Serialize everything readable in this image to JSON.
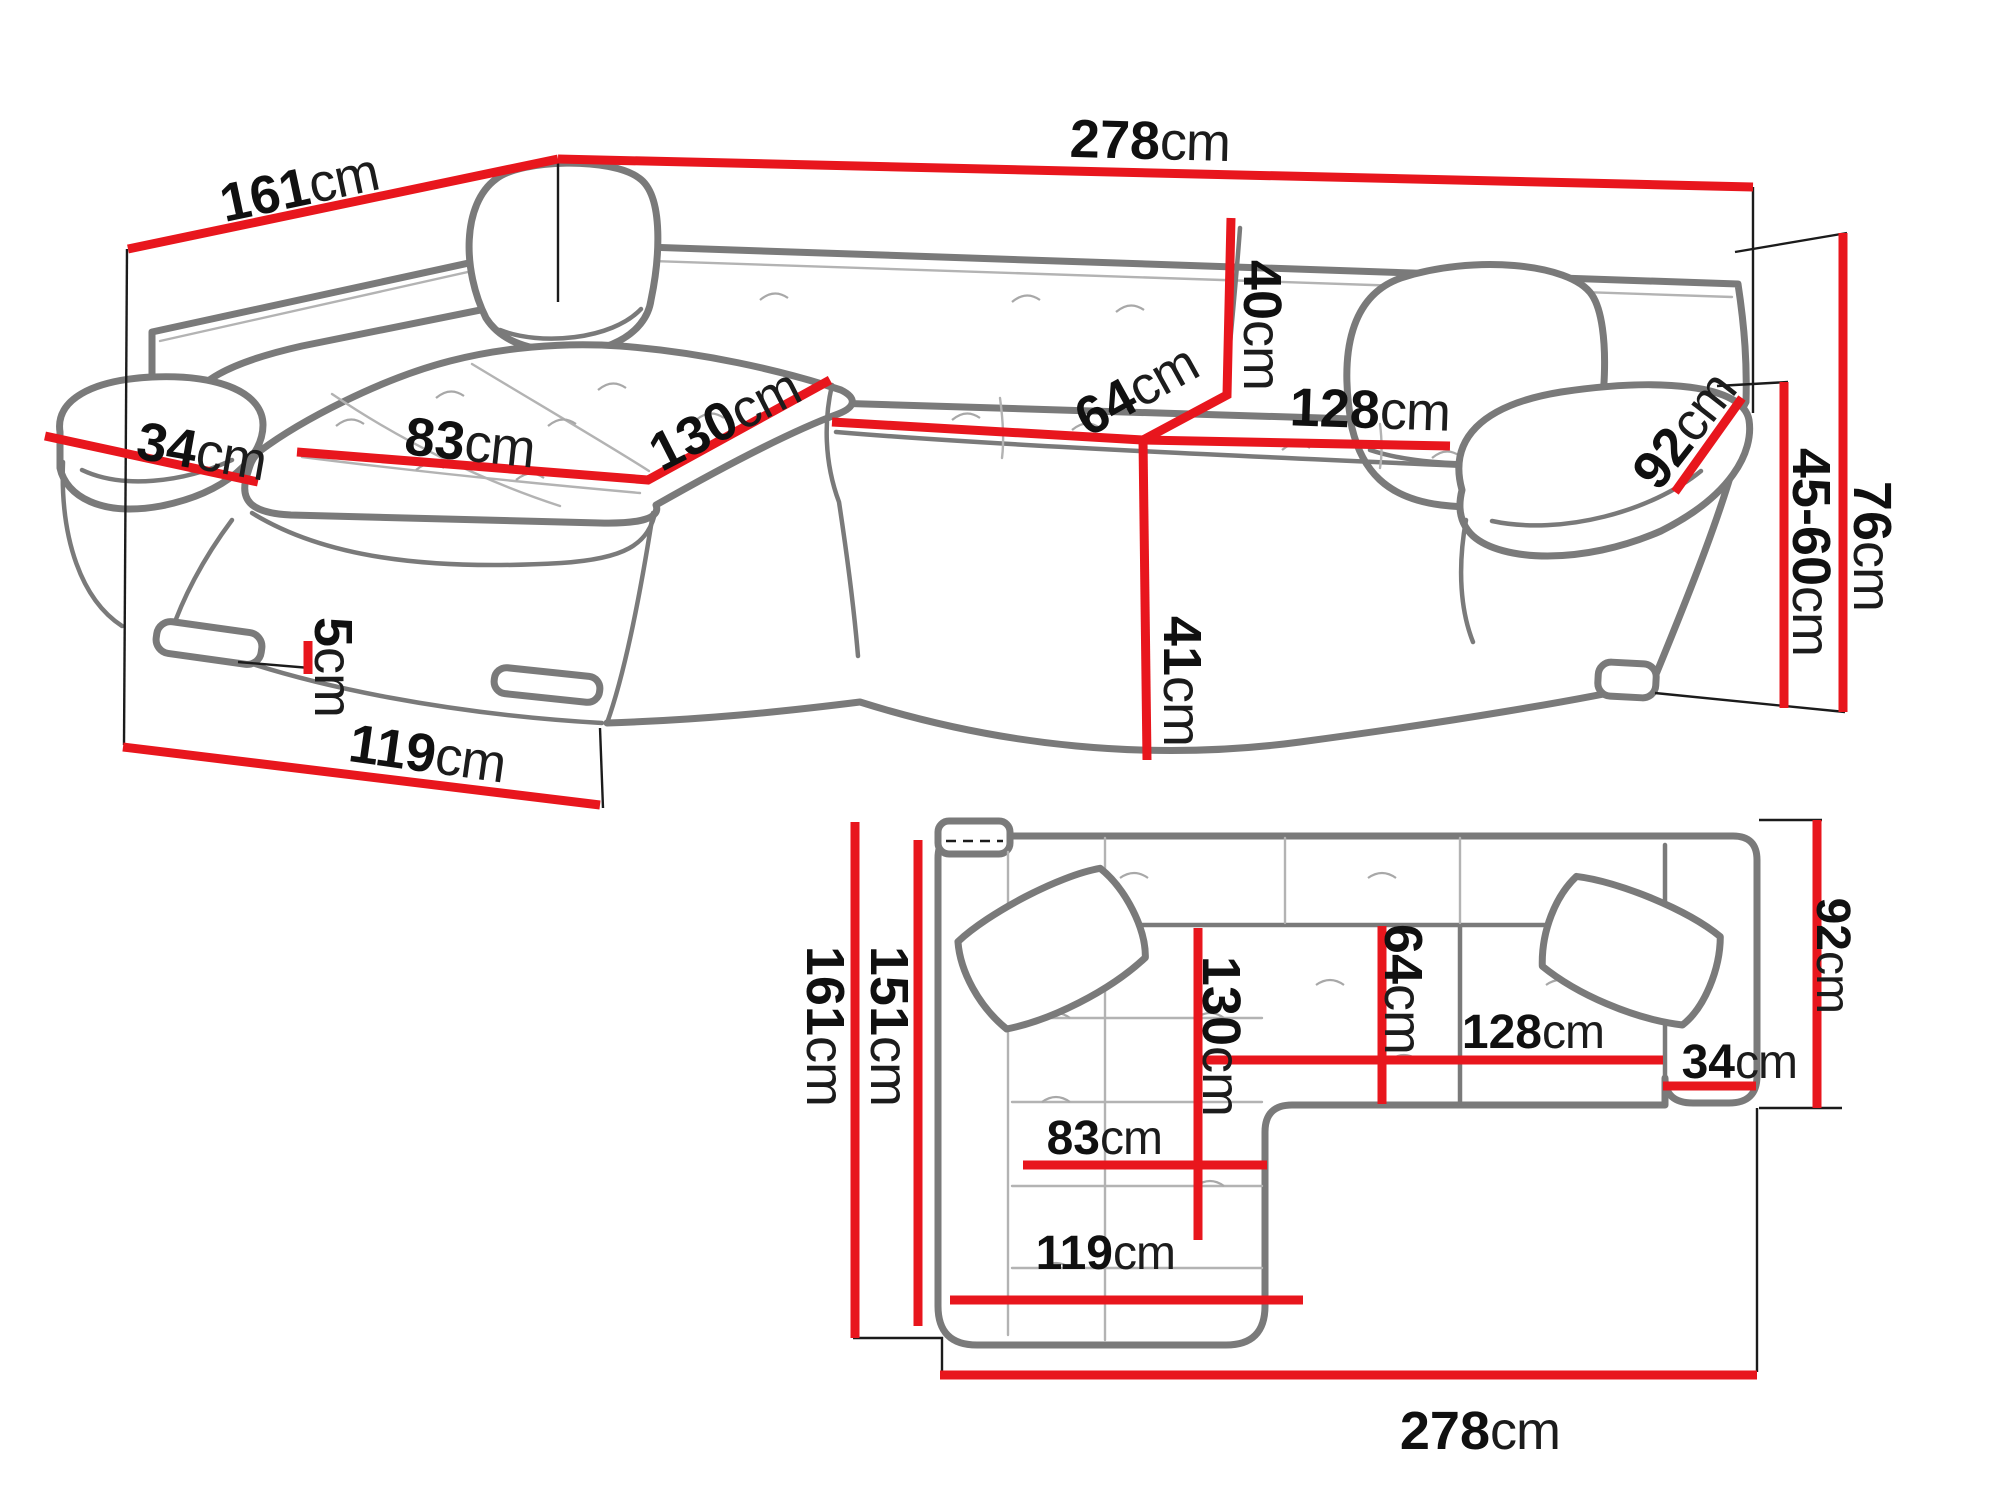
{
  "diagram": {
    "type": "corner-sofa dimension drawing",
    "unit": "cm",
    "colors": {
      "dimension_line": "#e8161d",
      "sofa_outline": "#7a7a7a",
      "label_text": "#101010",
      "background": "#ffffff"
    },
    "perspective_view": {
      "dimensions": {
        "total_width": {
          "value": "278",
          "unit": "cm"
        },
        "total_depth": {
          "value": "161",
          "unit": "cm"
        },
        "armrest_top_width": {
          "value": "34",
          "unit": "cm"
        },
        "chaise_seat_width": {
          "value": "83",
          "unit": "cm"
        },
        "chaise_seat_length": {
          "value": "130",
          "unit": "cm"
        },
        "backrest_height": {
          "value": "40",
          "unit": "cm"
        },
        "seat_depth": {
          "value": "64",
          "unit": "cm"
        },
        "seat_width": {
          "value": "128",
          "unit": "cm"
        },
        "armrest_length": {
          "value": "92",
          "unit": "cm"
        },
        "total_height": {
          "value": "76",
          "unit": "cm"
        },
        "adjustable_height": {
          "value": "45-60",
          "unit": "cm"
        },
        "seat_height": {
          "value": "41",
          "unit": "cm"
        },
        "leg_height": {
          "value": "5",
          "unit": "cm"
        },
        "chaise_outer_length": {
          "value": "119",
          "unit": "cm"
        }
      }
    },
    "plan_view": {
      "dimensions": {
        "total_depth": {
          "value": "161",
          "unit": "cm"
        },
        "inner_depth": {
          "value": "151",
          "unit": "cm"
        },
        "chaise_length": {
          "value": "130",
          "unit": "cm"
        },
        "chaise_seat_width": {
          "value": "83",
          "unit": "cm"
        },
        "chaise_outer_length": {
          "value": "119",
          "unit": "cm"
        },
        "total_width": {
          "value": "278",
          "unit": "cm"
        },
        "seat_depth": {
          "value": "64",
          "unit": "cm"
        },
        "seat_width": {
          "value": "128",
          "unit": "cm"
        },
        "armrest_width": {
          "value": "34",
          "unit": "cm"
        },
        "side_depth": {
          "value": "92",
          "unit": "cm"
        }
      }
    }
  }
}
